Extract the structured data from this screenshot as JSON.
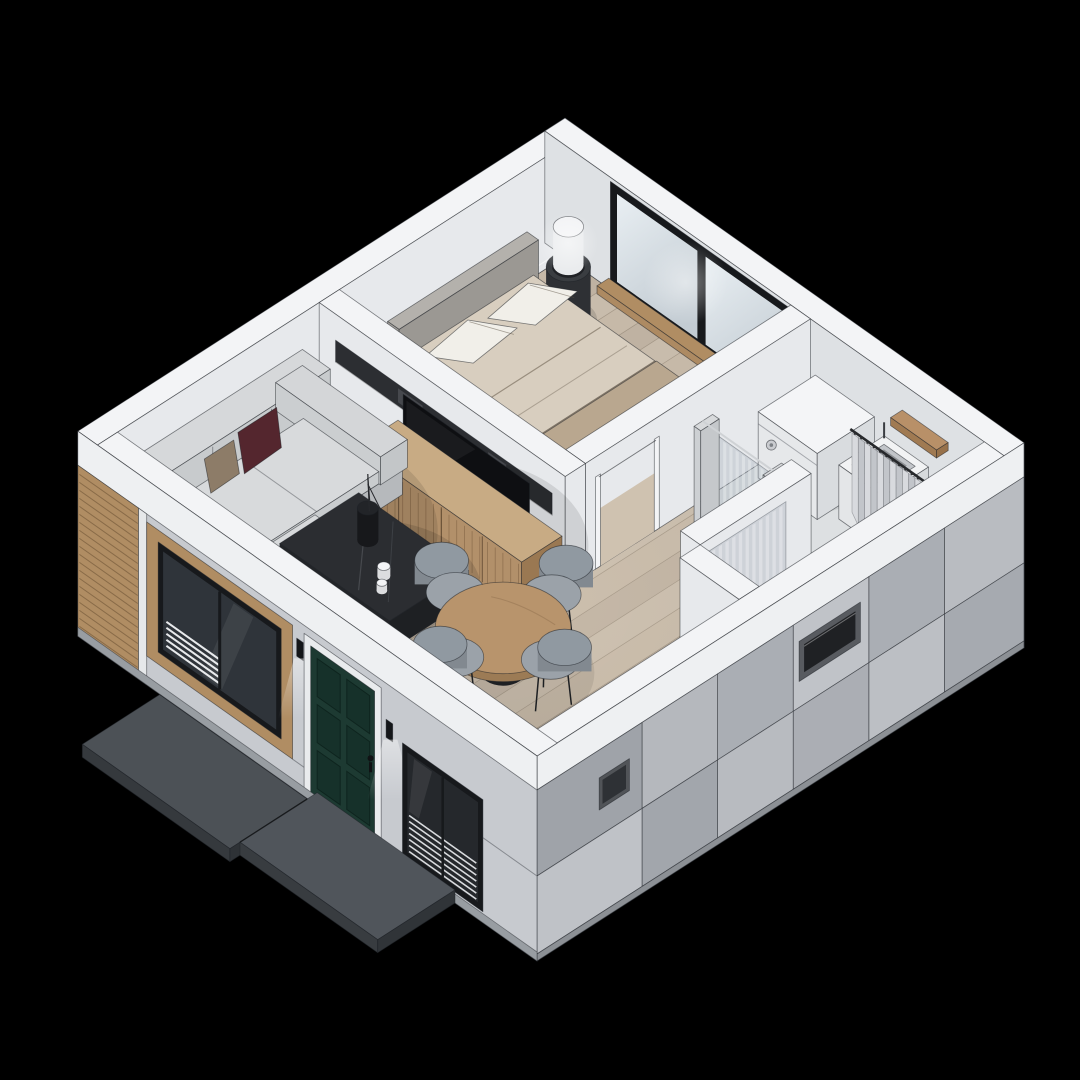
{
  "scene": {
    "title": "Isometric cutaway 3D render of a small one-bedroom house floor plan on a black background",
    "projection": "axonometric, roofless cutaway, viewed from above-southwest",
    "rooms": [
      {
        "name": "living-dining-room",
        "floor": "light oak plank flooring",
        "furniture": [
          "light gray fabric sofa with chaise",
          "burgundy accent pillow",
          "tan accent pillow",
          "dark marble square coffee table",
          "decor vase with dark branches",
          "two small candles",
          "oak TV console with slatted doors",
          "black flat-screen TV",
          "recessed dark media niche in divider wall",
          "round oak dining table with black pedestal",
          "four gray shell dining chairs"
        ]
      },
      {
        "name": "bedroom",
        "floor": "light oak plank flooring",
        "furniture": [
          "double bed with cream duvet",
          "taupe folded blanket",
          "two cream pillows",
          "gray upholstered headboard",
          "black ring nightstand",
          "white cylinder table lamp",
          "black-framed sliding window with wood sill",
          "door opening to hallway"
        ]
      },
      {
        "name": "bathroom-laundry",
        "floor": "gray tile",
        "furniture": [
          "white washing machine with round knob",
          "white square wash basin",
          "wood shelf",
          "striped glass partition with sliding door",
          "gray shower curtain on dark rail"
        ]
      },
      {
        "name": "hallway",
        "floor": "light oak plank flooring",
        "furniture": []
      }
    ],
    "exterior": [
      "white cut-top wall band",
      "light gray panel cladding with dark seams",
      "warm wood slat accent cladding at west corner",
      "wood-trimmed black-framed window",
      "dark green six-panel entry door",
      "two black cylinder wall sconces with downlight glow",
      "black-framed window with white blinds",
      "dark slit windows on southeast facade",
      "two dark concrete walkway slabs"
    ]
  },
  "palette": {
    "background": "#000000",
    "outline": "rgba(30,33,38,0.55)",
    "wallTop": "#f3f4f6",
    "wallInner": "#e7e9ec",
    "wallInnerShade": "#dee1e4",
    "floorWood": "#c6b9a8",
    "floorLine": "rgba(110,96,82,0.38)",
    "bathFloor": "#dde0e2",
    "panelLight": "#c7cacf",
    "panelMid": "#b3b6bb",
    "facadeBand": "#eef0f2",
    "woodSlat": "#b08d63",
    "doorGreen": "#1d3a32",
    "frameBlack": "#17191c",
    "glassDark": "#2f343a",
    "pathTop": "#4c5156",
    "sofaLight": "#d8dadc",
    "pillowBurgundy": "#54262e",
    "pillowTan": "#8d7c68",
    "marbleTop": "#2b2d31",
    "oakTop": "#c0a17a",
    "oakFront": "#ad8a62",
    "tvPanel": "#0e0f12",
    "duvet": "#d8cebf",
    "duvetFold": "#b9a78f",
    "pillowWhite": "#f1efe9",
    "headboard": "#b4b1ac",
    "applianceWhite": "#f4f5f7",
    "curtainLight": "#d8dade",
    "curtainDark": "#c2c5ca",
    "chairSeat": "#9ba2a9",
    "chairBack": "#828990",
    "lampWhite": "#f2f3f5"
  }
}
